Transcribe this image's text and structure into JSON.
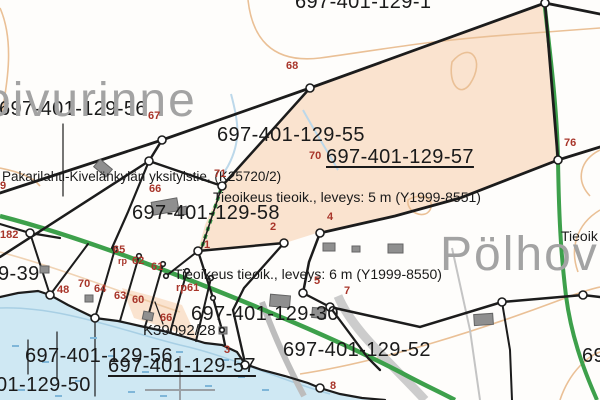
{
  "map": {
    "title": "Finnish cadastral map extract",
    "colors": {
      "parcel_fill": "#fae3cf",
      "water": "#cfe8f3",
      "road_green": "#3da04b",
      "boundary_black": "#1c1c1c",
      "point_red": "#a8352a",
      "placename_gray": "#a3a3a3",
      "building_gray": "#8f8f8f",
      "contour_orange": "#eac096",
      "marsh_blue": "#7fb6d8"
    },
    "legend_symbols": [
      {
        "name": "boundary-point-dot",
        "meaning": "parcel boundary point (white circle)"
      },
      {
        "name": "green-dashed-line",
        "meaning": "road easement marking"
      },
      {
        "name": "green-line",
        "meaning": "road"
      },
      {
        "name": "gray-cross",
        "meaning": "coordinate grid cross"
      }
    ],
    "labels": [
      {
        "text": "697-401-129-1",
        "x": 295,
        "y": -8,
        "cls": "parcel",
        "name": "parcel-label-129-1"
      },
      {
        "text": "697-401-129-56",
        "x": -1,
        "y": 99,
        "cls": "parcel",
        "name": "parcel-label-129-56-top"
      },
      {
        "text": "697-401-129-55",
        "x": 217,
        "y": 125,
        "cls": "parcel",
        "name": "parcel-label-129-55"
      },
      {
        "text": "697-401-129-57",
        "x": 326,
        "y": 147,
        "cls": "parcel u",
        "name": "parcel-label-129-57-top"
      },
      {
        "text": "697-401-129-58",
        "x": 132,
        "y": 203,
        "cls": "parcel",
        "name": "parcel-label-129-58"
      },
      {
        "text": "697-401-129-30",
        "x": 191,
        "y": 304,
        "cls": "parcel",
        "name": "parcel-label-129-30"
      },
      {
        "text": "697-401-129-52",
        "x": 283,
        "y": 340,
        "cls": "parcel",
        "name": "parcel-label-129-52"
      },
      {
        "text": "697-401-129-56",
        "x": 25,
        "y": 346,
        "cls": "parcel",
        "name": "parcel-label-129-56-bottom"
      },
      {
        "text": "697-401-129-57",
        "x": 108,
        "y": 356,
        "cls": "parcel u",
        "name": "parcel-label-129-57-bottom"
      },
      {
        "text": "01-129-50",
        "x": -4,
        "y": 375,
        "cls": "parcel",
        "name": "parcel-label-129-50-partial"
      },
      {
        "text": "9-39",
        "x": -2,
        "y": 264,
        "cls": "parcel",
        "name": "parcel-label-129-39-partial"
      },
      {
        "text": "69",
        "x": 582,
        "y": 346,
        "cls": "parcel",
        "name": "parcel-label-right-edge-partial"
      },
      {
        "text": "K39092/28",
        "x": 143,
        "y": 323,
        "cls": "k",
        "name": "document-number-label"
      },
      {
        "text": "Pakarilahti-Kivelänkylän yksityistie, (K25720/2)",
        "x": 2,
        "y": 170,
        "cls": "road",
        "name": "private-road-name-label"
      },
      {
        "text": "Tieoikeus tieoik., leveys: 5 m (Y1999-8551)",
        "x": 213,
        "y": 190,
        "cls": "ease",
        "name": "easement-label-5m"
      },
      {
        "text": "Tieoikeus tieoik., leveys: 6 m (Y1999-8550)",
        "x": 174,
        "y": 267,
        "cls": "ease",
        "name": "easement-label-6m"
      },
      {
        "text": "Tieoik",
        "x": 561,
        "y": 229,
        "cls": "ease",
        "name": "easement-label-right-partial"
      },
      {
        "text": "oivurinne",
        "x": -16,
        "y": 76,
        "cls": "place",
        "name": "place-name-oivurinne"
      },
      {
        "text": "Pölhov",
        "x": 440,
        "y": 230,
        "cls": "place",
        "name": "place-name-polhov"
      },
      {
        "text": "68",
        "x": 286,
        "y": 61,
        "cls": "pt",
        "name": "point-number-68"
      },
      {
        "text": "67",
        "x": 148,
        "y": 111,
        "cls": "pt",
        "name": "point-number-67"
      },
      {
        "text": "76",
        "x": 564,
        "y": 138,
        "cls": "pt",
        "name": "point-number-76"
      },
      {
        "text": "70",
        "x": 309,
        "y": 151,
        "cls": "pt",
        "name": "point-number-70-upper"
      },
      {
        "text": "71",
        "x": 214,
        "y": 169,
        "cls": "pt",
        "name": "point-number-71"
      },
      {
        "text": "66",
        "x": 149,
        "y": 184,
        "cls": "pt",
        "name": "point-number-66-upper"
      },
      {
        "text": "9",
        "x": 0,
        "y": 181,
        "cls": "pt",
        "name": "point-number-9-partial"
      },
      {
        "text": "182",
        "x": 0,
        "y": 230,
        "cls": "pt",
        "name": "point-number-182"
      },
      {
        "text": "2",
        "x": 270,
        "y": 222,
        "cls": "pt",
        "name": "point-number-2"
      },
      {
        "text": "4",
        "x": 327,
        "y": 212,
        "cls": "pt",
        "name": "point-number-4"
      },
      {
        "text": "1",
        "x": 204,
        "y": 240,
        "cls": "pt",
        "name": "point-number-1"
      },
      {
        "text": "65",
        "x": 113,
        "y": 245,
        "cls": "pt",
        "name": "point-number-65"
      },
      {
        "text": "rp",
        "x": 118,
        "y": 257,
        "cls": "pt-s",
        "name": "point-marker-rp"
      },
      {
        "text": "62",
        "x": 132,
        "y": 256,
        "cls": "pt",
        "name": "point-number-62"
      },
      {
        "text": "61",
        "x": 151,
        "y": 262,
        "cls": "pt",
        "name": "point-number-61"
      },
      {
        "text": "rp61",
        "x": 176,
        "y": 283,
        "cls": "pt",
        "name": "point-marker-rp61"
      },
      {
        "text": "48",
        "x": 57,
        "y": 285,
        "cls": "pt",
        "name": "point-number-48"
      },
      {
        "text": "70",
        "x": 78,
        "y": 279,
        "cls": "pt",
        "name": "point-number-70-lower"
      },
      {
        "text": "64",
        "x": 94,
        "y": 284,
        "cls": "pt",
        "name": "point-number-64"
      },
      {
        "text": "63",
        "x": 114,
        "y": 291,
        "cls": "pt",
        "name": "point-number-63"
      },
      {
        "text": "60",
        "x": 132,
        "y": 295,
        "cls": "pt",
        "name": "point-number-60"
      },
      {
        "text": "5",
        "x": 314,
        "y": 276,
        "cls": "pt",
        "name": "point-number-5"
      },
      {
        "text": "7",
        "x": 344,
        "y": 286,
        "cls": "pt",
        "name": "point-number-7"
      },
      {
        "text": "66",
        "x": 160,
        "y": 313,
        "cls": "pt",
        "name": "point-number-66-lower"
      },
      {
        "text": "3",
        "x": 224,
        "y": 345,
        "cls": "pt",
        "name": "point-number-3"
      },
      {
        "text": "8",
        "x": 330,
        "y": 381,
        "cls": "pt",
        "name": "point-number-8"
      }
    ]
  }
}
